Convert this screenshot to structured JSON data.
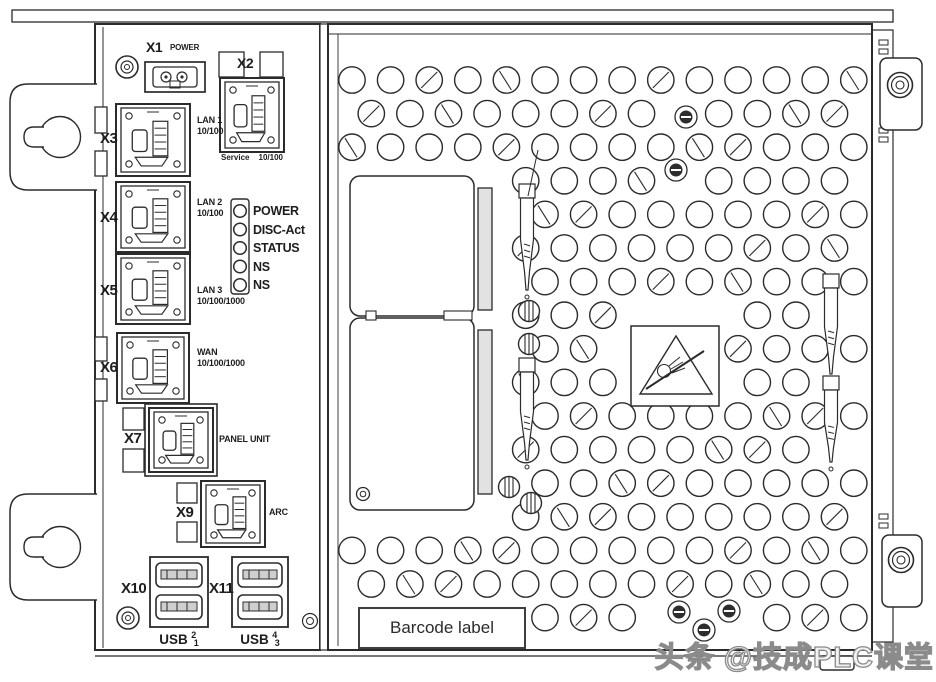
{
  "page": {
    "background": "#ffffff"
  },
  "colors": {
    "line": "#2b2b2b",
    "fill_light": "#e2e2e2",
    "dark_fill": "#2d2d2d",
    "watermark_stroke": "#8b8b8b",
    "text": "#1d1d1d"
  },
  "connector_panel": {
    "x1": {
      "name": "X1",
      "label": "POWER"
    },
    "x2": {
      "name": "X2",
      "label_left": "Service",
      "label_right": "10/100"
    },
    "x3": {
      "name": "X3",
      "line1": "LAN 1",
      "line2": "10/100"
    },
    "x4": {
      "name": "X4",
      "line1": "LAN 2",
      "line2": "10/100"
    },
    "x5": {
      "name": "X5",
      "line1": "LAN 3",
      "line2": "10/100/1000"
    },
    "x6": {
      "name": "X6",
      "line1": "WAN",
      "line2": "10/100/1000"
    },
    "x7": {
      "name": "X7",
      "label": "PANEL UNIT"
    },
    "x9": {
      "name": "X9",
      "label": "ARC"
    },
    "x10": {
      "name": "X10",
      "usb_base": "USB",
      "usb_sup": "2",
      "usb_sub": "1"
    },
    "x11": {
      "name": "X11",
      "usb_base": "USB",
      "usb_sup": "4",
      "usb_sub": "3"
    }
  },
  "leds": {
    "labels": [
      "POWER",
      "DISC-Act",
      "STATUS",
      "NS",
      "NS"
    ]
  },
  "panel": {
    "barcode_label": "Barcode label"
  },
  "watermark": {
    "text": "头条 @技成PLC课堂"
  }
}
